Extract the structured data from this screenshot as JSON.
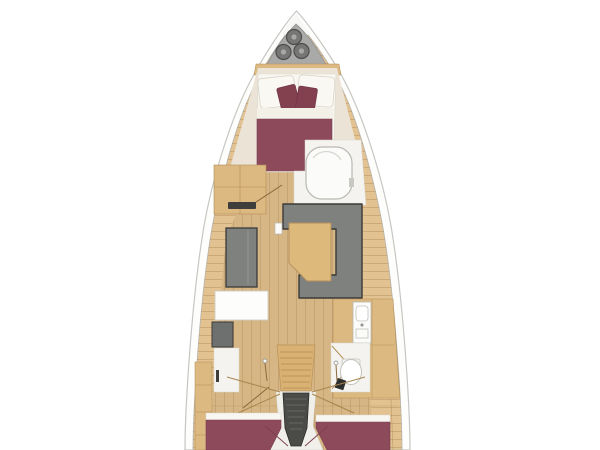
{
  "image": {
    "subject": "sailing-yacht-interior-floor-plan",
    "view": "top-down"
  },
  "regions": [
    "bow-anchor-locker",
    "forward-owner-cabin",
    "forward-head-shower",
    "saloon",
    "port-settee",
    "navigation-station",
    "starboard-dinette",
    "galley",
    "aft-head",
    "companionway-stairs",
    "port-aft-cabin",
    "starboard-aft-cabin"
  ],
  "colors": {
    "background": "#ffffff",
    "hull_band": "#fdfdfc",
    "hull_outline": "#c6c6c3",
    "deck_wood": "#e2c290",
    "floor_wood": "#d6b685",
    "furniture_wood": "#dcb981",
    "wood_line": "#b28e59",
    "anchor_locker": "#a9a9a7",
    "hatch_fill": "#767674",
    "hatch_ring": "#4d4d4b",
    "cream_floor": "#ebe4d6",
    "bedding_white": "#f8f6f0",
    "sheet_white": "#f3f0e8",
    "bed_maroon": "#8c4a5b",
    "cushion_maroon": "#83404f",
    "sofa_gray": "#7f817e",
    "sofa_outline": "#3a3a38",
    "stairs_wood": "#d9b273",
    "stairs_dark": "#4b4b48",
    "white_fixture": "#fbfbf9",
    "fixture_outline": "#b9b8b2",
    "white_floor": "#f4f3ef",
    "seat_dark": "#6e706f",
    "handle_dark": "#3e3e3c",
    "swing_line": "#a8864f",
    "bed_line": "#7c3f50"
  }
}
